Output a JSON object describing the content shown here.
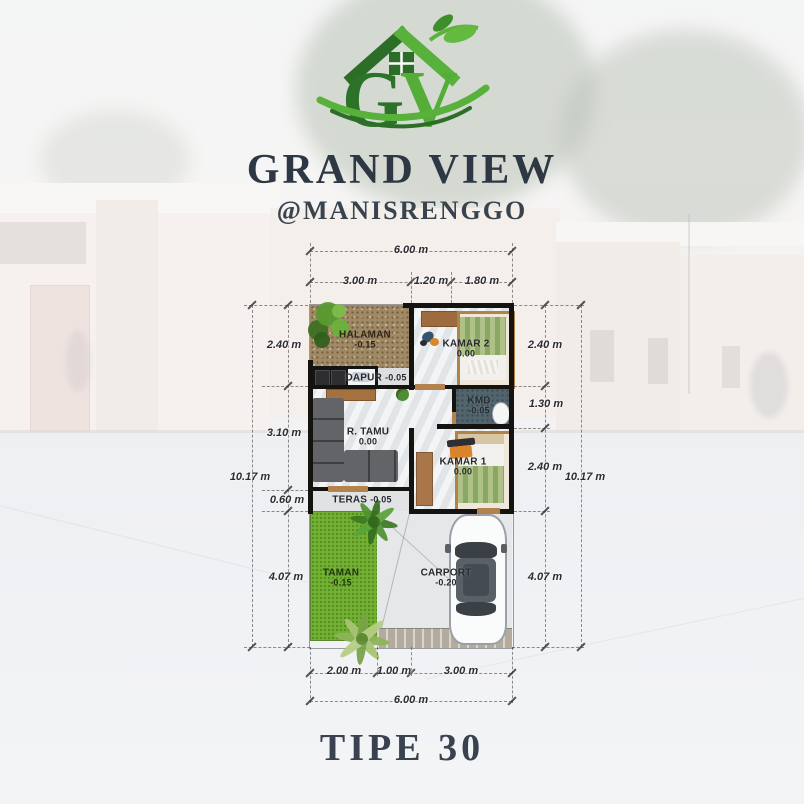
{
  "poster": {
    "logo": {
      "letter_g": "G",
      "letter_v": "V"
    },
    "title": "GRAND VIEW",
    "subtitle": "@MANISRENGGO",
    "type_label": "TIPE 30"
  },
  "floor_plan": {
    "rooms": {
      "halaman": {
        "name": "HALAMAN",
        "level": "-0.15"
      },
      "dapur": {
        "name": "DAPUR",
        "level": "-0.05"
      },
      "kamar2": {
        "name": "KAMAR 2",
        "level": "0.00"
      },
      "kmd": {
        "name": "KMD",
        "level": "-0.05"
      },
      "r_tamu": {
        "name": "R. TAMU",
        "level": "0.00"
      },
      "kamar1": {
        "name": "KAMAR 1",
        "level": "0.00"
      },
      "teras": {
        "name": "TERAS",
        "level": "-0.05"
      },
      "taman": {
        "name": "TAMAN",
        "level": "-0.15"
      },
      "carport": {
        "name": "CARPORT",
        "level": "-0.20"
      }
    },
    "dimensions": {
      "top": {
        "total": "6.00 m",
        "segments": [
          "3.00 m",
          "1.20 m",
          "1.80 m"
        ]
      },
      "bottom": {
        "total": "6.00 m",
        "segments": [
          "2.00 m",
          "1.00 m",
          "3.00 m"
        ]
      },
      "left": {
        "total": "10.17 m",
        "segments": [
          "2.40 m",
          "3.10 m",
          "0.60 m",
          "4.07 m"
        ]
      },
      "right": {
        "total": "10.17 m",
        "segments": [
          "2.40 m",
          "1.30 m",
          "2.40 m",
          "4.07 m"
        ]
      }
    }
  },
  "colors": {
    "logo_green_dark": "#2c7229",
    "logo_green_light": "#5cb33a",
    "title_text": "#2e3844",
    "dimension_text": "#2c2d31",
    "wall": "#151310",
    "halaman_soil": "#a08a66",
    "taman_grass": "#74b133",
    "kmd_floor": "#52646d",
    "wood": "#9d6b3e",
    "bed_frame": "#c59c66",
    "sofa": "#55575a"
  }
}
